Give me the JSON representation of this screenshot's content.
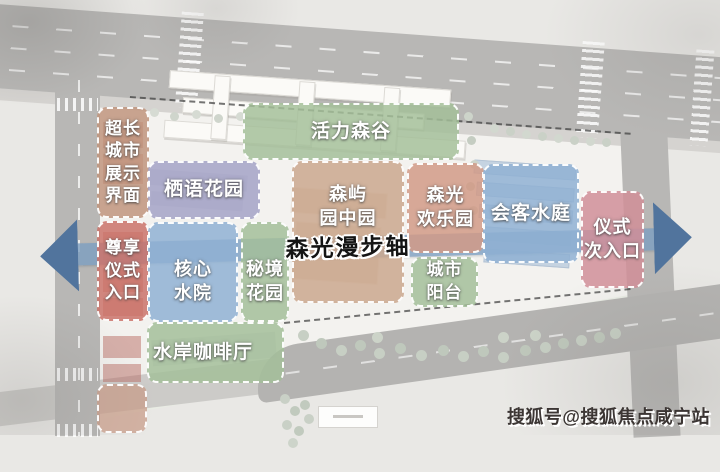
{
  "axis": {
    "label": "森光漫步轴"
  },
  "watermark": {
    "text": "搜狐号@搜狐焦点咸宁站"
  },
  "colors": {
    "axis_band": "#7c9dc1",
    "axis_head": "#51749d",
    "zone_border": "#ffffff",
    "road": "#b8b7b5",
    "paper": "#e9e8e5",
    "watermark_text": "#3c3634"
  },
  "zones": {
    "display_interface": {
      "label": "超长\n城市\n展示\n界面",
      "color": "#c0947c"
    },
    "ceremony_entrance": {
      "label": "尊享\n仪式\n入口",
      "color": "#ca7168"
    },
    "entry_extension": {
      "label": "",
      "color": "#c79a86"
    },
    "vitality_valley": {
      "label": "活力森谷",
      "color": "#a3bf98"
    },
    "qiyu_garden": {
      "label": "栖语花园",
      "color": "#a3a2c6"
    },
    "senyu_garden": {
      "label": "森屿\n园中园",
      "color": "#cba78d"
    },
    "joy_park": {
      "label": "森光\n欢乐园",
      "color": "#d29a85"
    },
    "guest_water_court": {
      "label": "会客水庭",
      "color": "#8fb0d3"
    },
    "secondary_entrance": {
      "label": "仪式\n次入口",
      "color": "#d08e97"
    },
    "core_water_yard": {
      "label": "核心\n水院",
      "color": "#8fb0d3"
    },
    "secret_garden": {
      "label": "秘境\n花园",
      "color": "#a3bf98"
    },
    "city_balcony": {
      "label": "城市\n阳台",
      "color": "#a3bf98"
    },
    "waterfront_cafe": {
      "label": "水岸咖啡厅",
      "color": "#a3bf98"
    }
  }
}
